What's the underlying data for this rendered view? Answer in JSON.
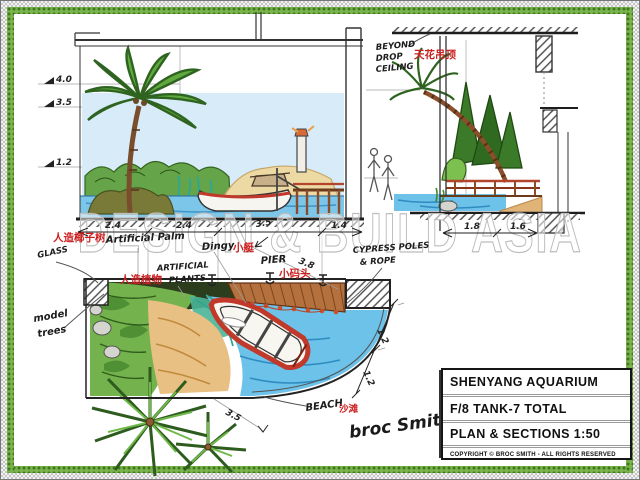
{
  "watermark": "DESIGN & BUILD ASIA",
  "title_block": {
    "project": "SHENYANG AQUARIUM",
    "sheet": "F/8 TANK-7 TOTAL",
    "content": "PLAN & SECTIONS 1:50",
    "copyright": "COPYRIGHT © BROC SMITH - ALL RIGHTS RESERVED"
  },
  "levels": {
    "l1": "4.0",
    "l2": "3.5",
    "l3": "1.2"
  },
  "dims": {
    "main": [
      "2.4",
      "2.4",
      "3.5",
      "1.4"
    ],
    "section": [
      "1.8",
      "1.6"
    ],
    "plan_diag": [
      "1.2",
      "1.2"
    ],
    "pier_diag": "3.8",
    "beach": "3.5"
  },
  "labels": {
    "drop_ceiling_en1": "BEYOND",
    "drop_ceiling_en2": "DROP",
    "drop_ceiling_en3": "CEILING",
    "drop_ceiling_cn": "天花吊顶",
    "artificial_palm_cn": "人造椰子树",
    "artificial_palm_en": "Artificial Palm",
    "dinghy_en": "Dingy",
    "dinghy_cn": "小艇",
    "artificial_plants_cn": "人造植物",
    "artificial_plants_en1": "ARTIFICIAL",
    "artificial_plants_en2": "PLANTS",
    "pier_en": "PIER",
    "pier_cn": "小码头",
    "cypress_en1": "CYPRESS POLES",
    "cypress_en2": "& ROPE",
    "glass": "GLASS",
    "model_trees1": "model",
    "model_trees2": "trees",
    "beach_en": "BEACH",
    "beach_cn": "沙滩",
    "signature": "broc Smith"
  }
}
